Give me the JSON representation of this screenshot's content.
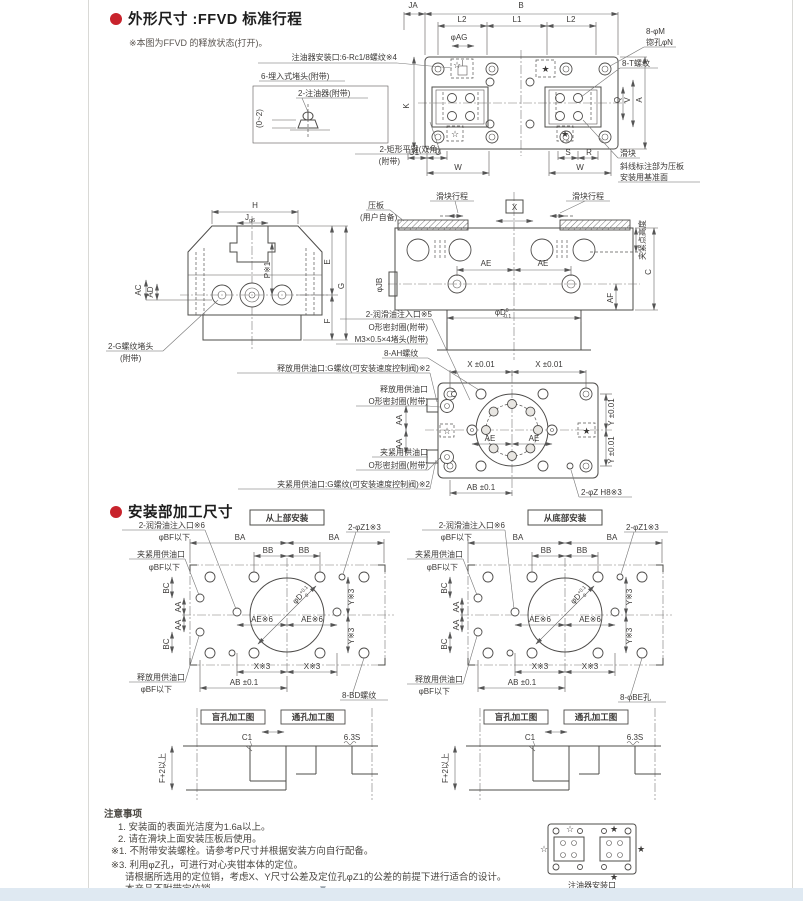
{
  "page": {
    "s1_title": "外形尺寸 :FFVD 标准行程",
    "s1_note": "※本图为FFVD 的释放状态(打开)。",
    "s2_title": "安装部加工尺寸",
    "footer_caption": "注油器安装口",
    "page_marker": "▼"
  },
  "dims": {
    "ja": "JA",
    "b": "B",
    "l1": "L1",
    "l2": "L2",
    "k": "K",
    "q": "Q",
    "v": "V",
    "a": "A",
    "u1": "U1",
    "u": "U",
    "w": "W",
    "s": "S",
    "r": "R",
    "h": "H",
    "j": "J",
    "jg6": "g6",
    "e": "E",
    "g": "G",
    "f": "F",
    "p1": "P※1",
    "ac": "AC",
    "ad": "AD",
    "ae": "AE",
    "c": "C",
    "af": "AF",
    "phiag": "φAG",
    "phijb": "φJB",
    "phid": "φD",
    "x": "X",
    "x001": "X ±0.01",
    "y001": "Y ±0.01",
    "ab01": "AB ±0.1",
    "aa": "AA",
    "ba": "BA",
    "bb": "BB",
    "bc": "BC",
    "x3": "X※3",
    "y3": "Y※3",
    "ae6": "AE※6",
    "c1": "C1",
    "finish": "6.3S",
    "f2": "F+2以上",
    "told_top": "0",
    "told_bot": "-0.1",
    "told2_top": "+0.1",
    "told2_bot": "0"
  },
  "callouts": {
    "oiler_port": "注油器安装口:6-Rc1/8螺纹※4",
    "plug6": "6-埋入式堵头(附带)",
    "oiler2": "2-注油器(附带)",
    "range02": "(0~2)",
    "key2": "2-矩形平键(双角)",
    "attached": "(附带)",
    "m8": "8-φM",
    "spotface": "锪孔φN",
    "t8": "8-T螺纹",
    "slider": "滑块",
    "hatch1": "斜线标注部为压板",
    "hatch2": "安装用基准面",
    "plate": "压板",
    "user": "(用户自备)",
    "stroke": "滑块行程",
    "clamp_height": "夹紧点高度",
    "gplug": "2-G螺纹堵头",
    "lube5": "2-润滑油注入口※5",
    "oring": "O形密封圈(附带)",
    "m3plug": "M3×0.5×4堵头(附带)",
    "ah8": "8-AH螺纹",
    "release_g": "释放用供油口:G螺纹(可安装速度控制阀)※2",
    "release": "释放用供油口",
    "clamp_port": "夹紧用供油口",
    "clamp_g": "夹紧用供油口:G螺纹(可安装速度控制阀)※2",
    "z2": "2-φZ H8※3",
    "z1": "2-φZ1※3",
    "top_mount": "从上部安装",
    "bottom_mount": "从底部安装",
    "lube6": "2-润滑油注入口※6",
    "bf": "φBF以下",
    "bd8": "8-BD螺纹",
    "be8": "8-φBE孔",
    "blind": "盲孔加工图",
    "through": "通孔加工图",
    "star_open": "☆",
    "star_filled": "★"
  },
  "notes": {
    "title": "注意事项",
    "n1": "1. 安装面的表面光洁度为1.6a以上。",
    "n2": "2. 请在滑块上面安装压板后使用。",
    "n3": "※1. 不附带安装螺栓。请参考P尺寸并根据安装方向自行配备。",
    "n4": "※3. 利用φZ孔，可进行对心夹钳本体的定位。",
    "n5": "请根据所选用的定位销，考虑X、Y尺寸公差及定位孔φZ1的公差的前提下进行适合的设计。",
    "n6": "本产品不附带定位销。"
  },
  "colors": {
    "accent_red": "#c8232c",
    "line": "#4e4c4a",
    "footer_band": "#dfe9f2"
  }
}
